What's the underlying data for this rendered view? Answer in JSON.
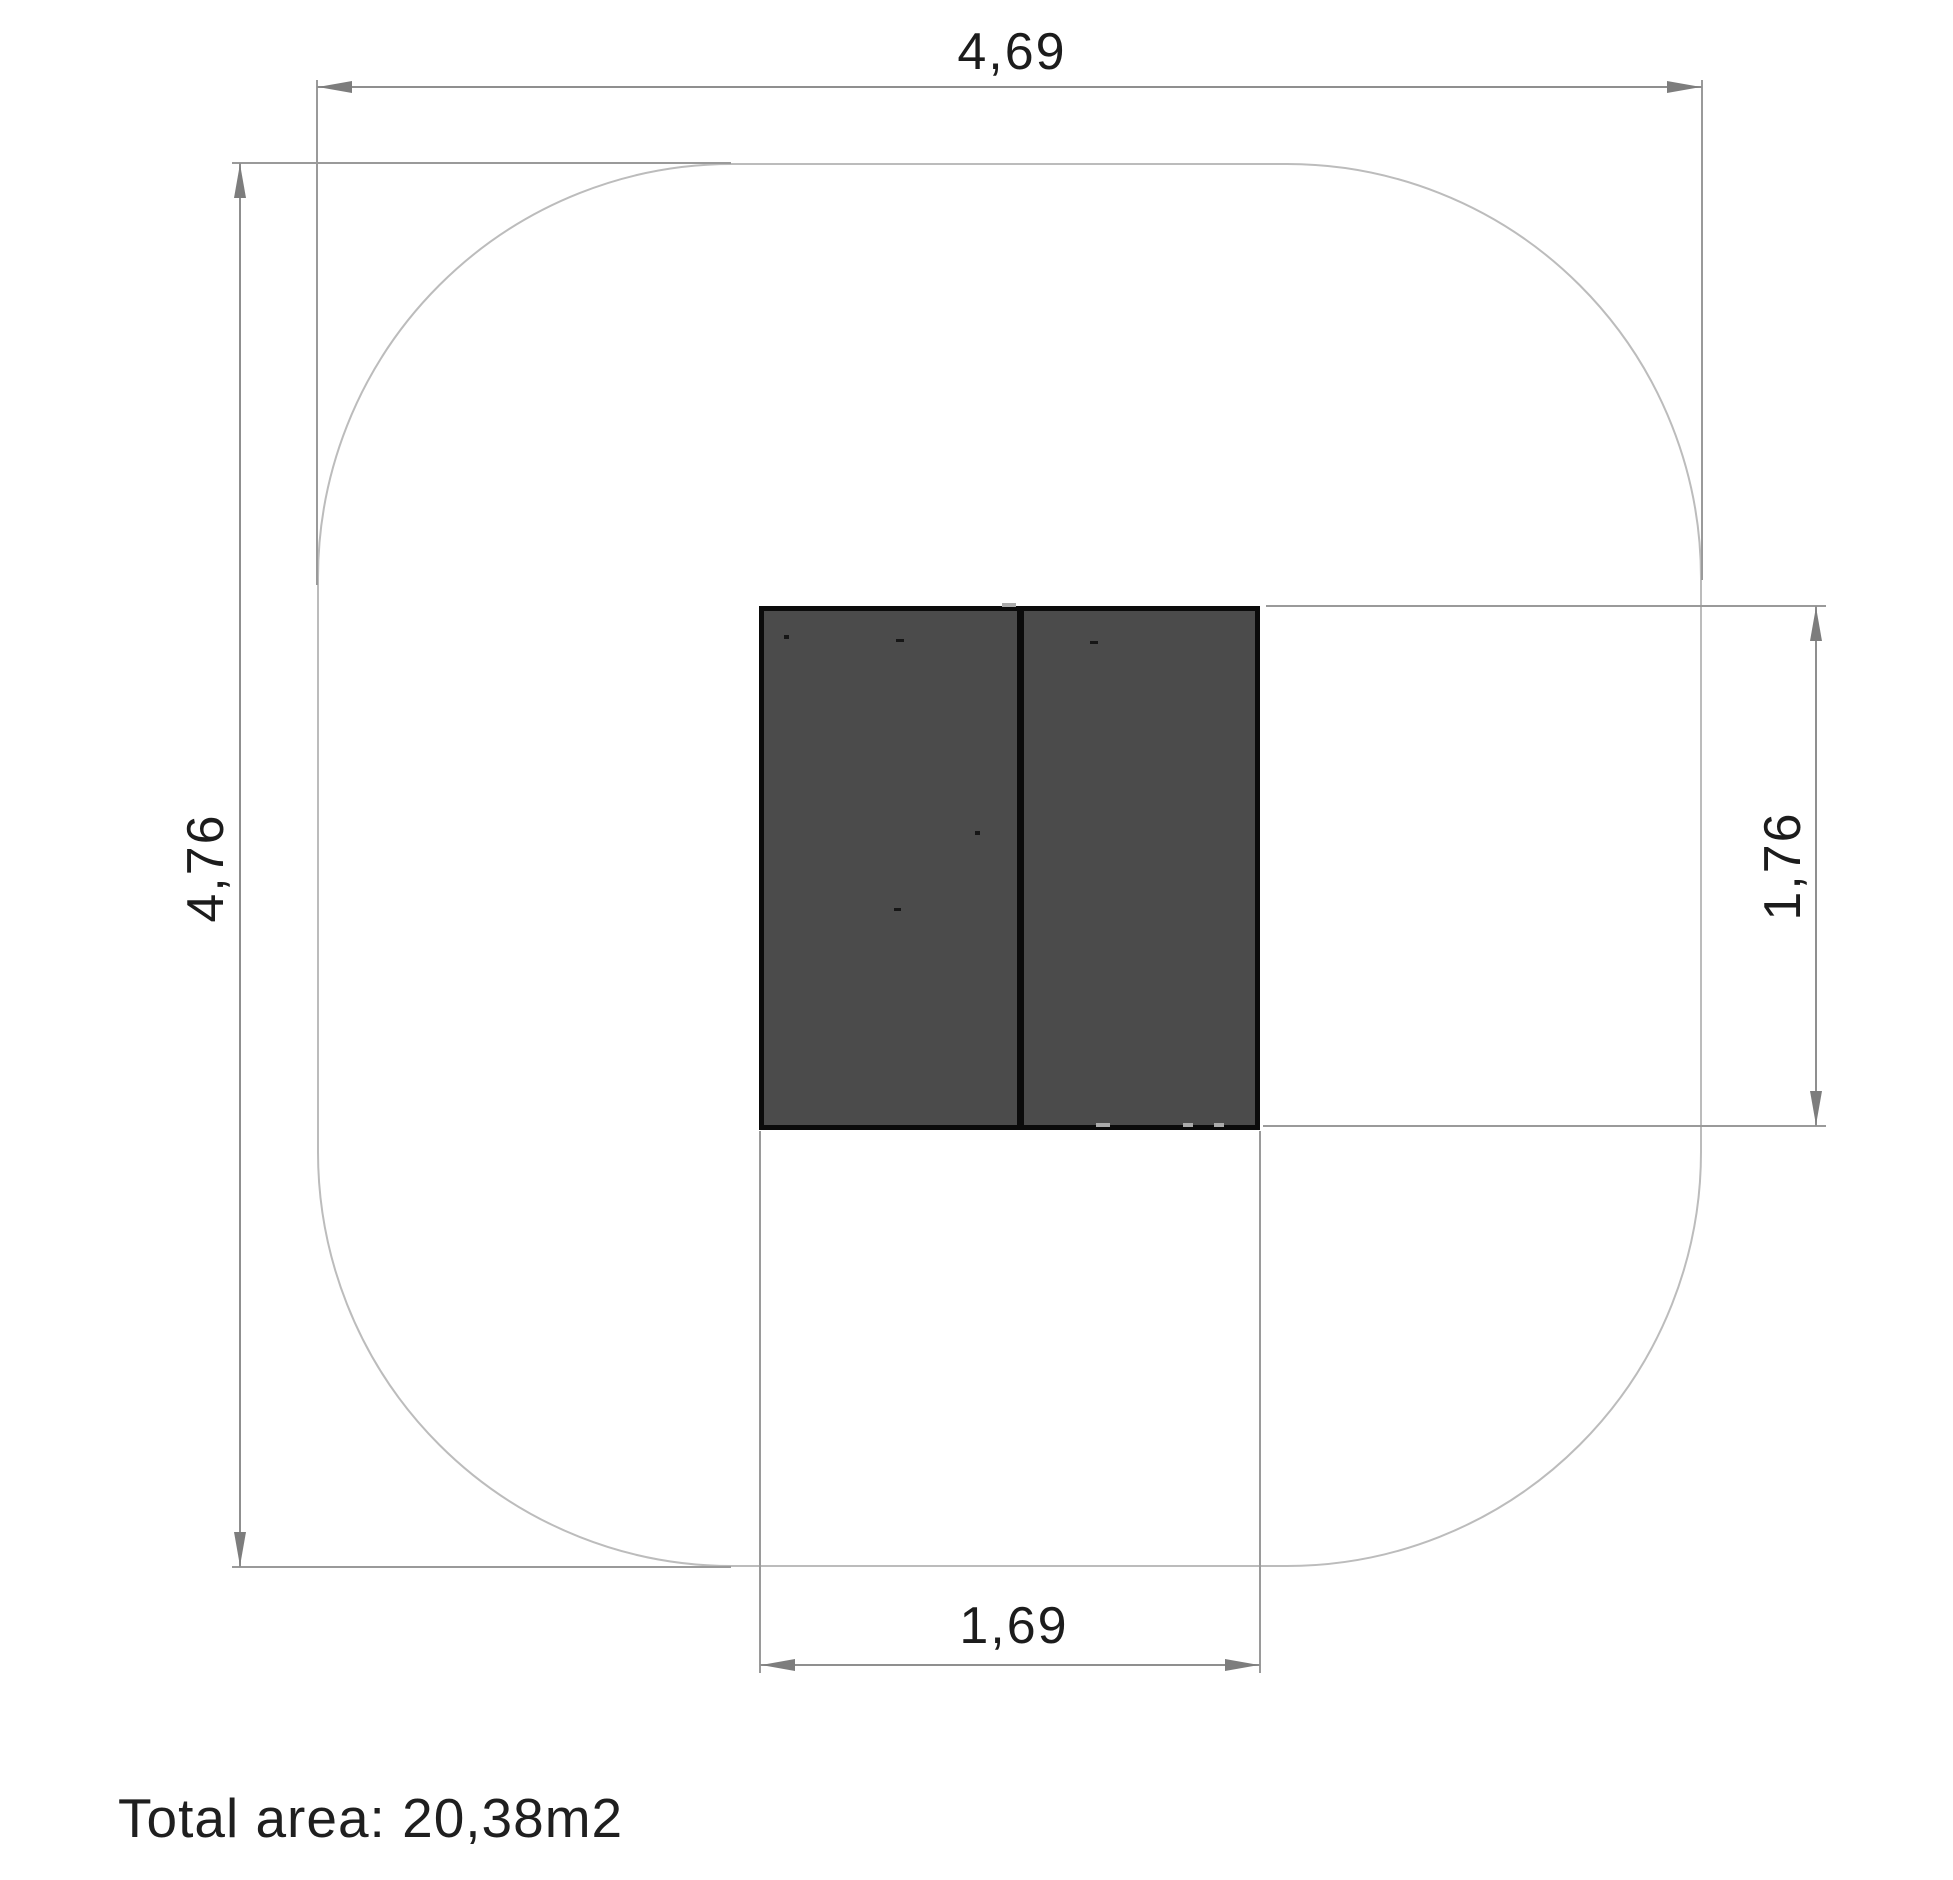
{
  "drawing": {
    "type": "plan-view technical drawing",
    "dimensions": {
      "total_width": {
        "label": "4,69"
      },
      "total_height": {
        "label": "4,76"
      },
      "equipment_height": {
        "label": "1,76"
      },
      "equipment_width": {
        "label": "1,69"
      }
    },
    "footer": {
      "total_area": "Total area: 20,38m2"
    },
    "colors": {
      "background": "#ffffff",
      "safety_outline": "#bcbcbc",
      "dimension_lines": "#8f8f8f",
      "arrowheads": "#7d7d7d",
      "equipment_fill": "#4b4b4b",
      "equipment_border": "#0b0b0b",
      "text": "#1c1c1c"
    }
  }
}
